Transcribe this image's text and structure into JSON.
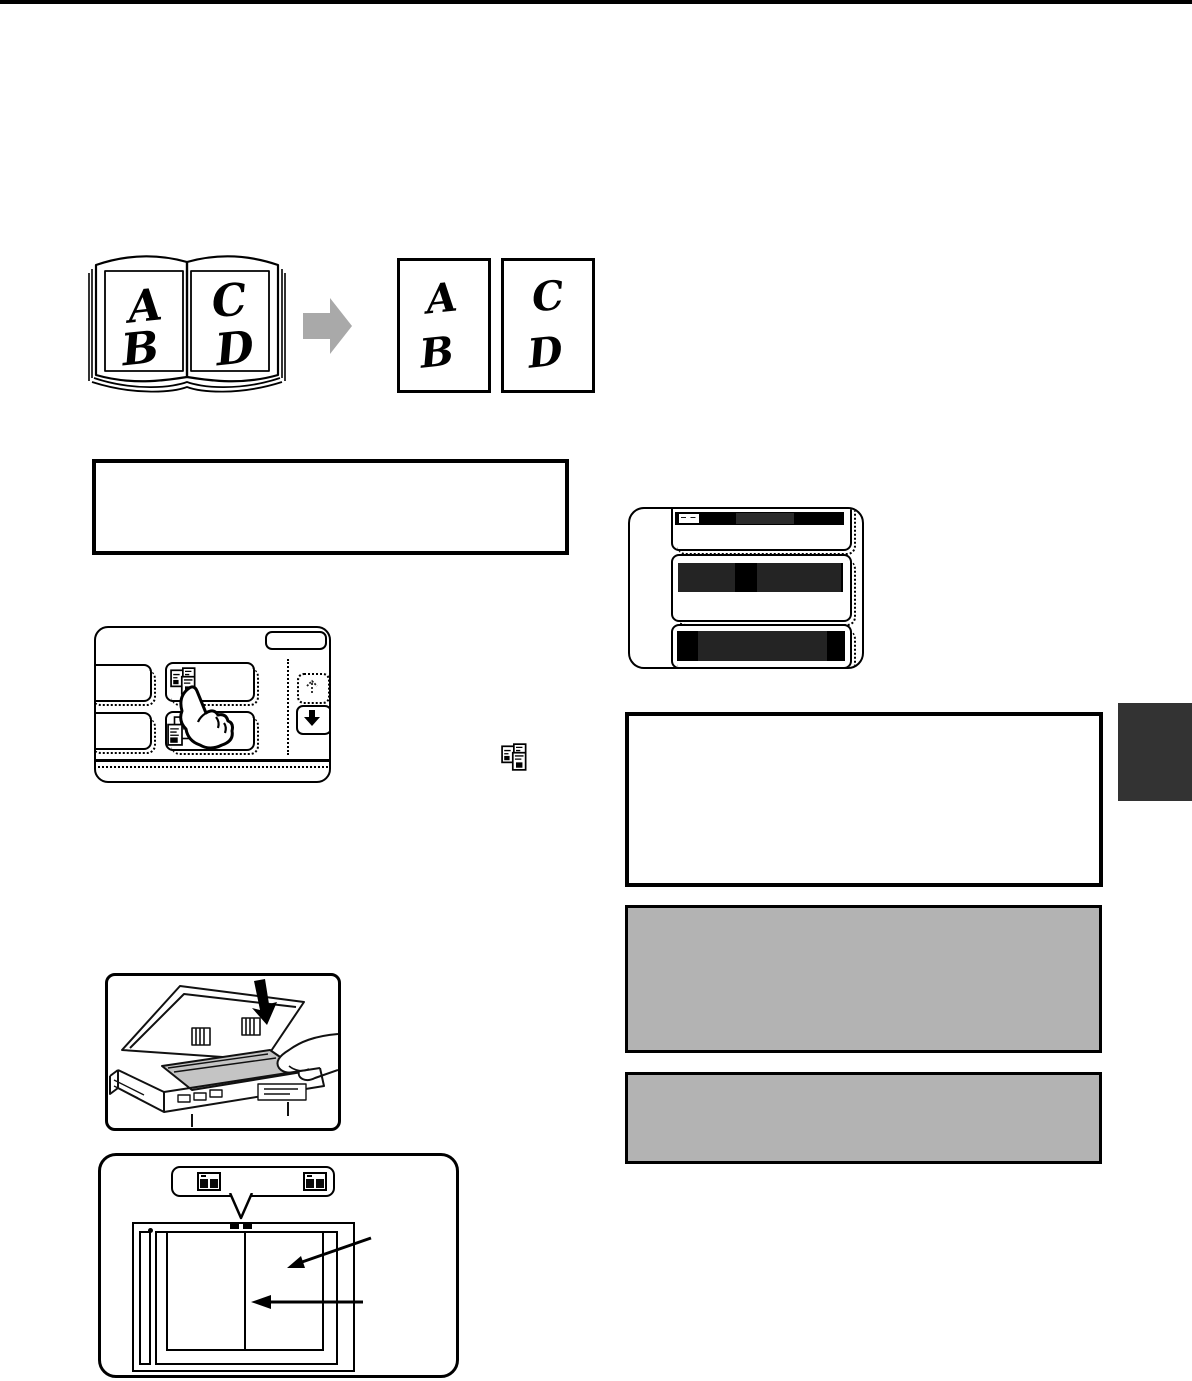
{
  "page": {
    "background": "#ffffff",
    "top_bar_color": "#000000",
    "section_tab_color": "#333333"
  },
  "colors": {
    "gray_box_fill": "#b3b3b3",
    "arrow_gray": "#a9a9a9",
    "glass_gray": "#c4c4c4",
    "screen_redaction_dark": "#242424",
    "screen_redaction_black": "#000000"
  },
  "figure_book_to_sheets": {
    "book_left_page": [
      "A",
      "B"
    ],
    "book_right_page": [
      "C",
      "D"
    ],
    "sheet_1": [
      "A",
      "B"
    ],
    "sheet_2": [
      "C",
      "D"
    ]
  },
  "panel_screen": {
    "header_dashes": "‒ ‒"
  },
  "icons": {
    "dual_page_copy_icon": "open book splitting into two separate pages",
    "stacked_pages_icon": "stacked sheets with text lines",
    "scroll_up_icon": "dashed up arrow",
    "scroll_down_icon": "solid black down arrow",
    "open_book_mark_icon": "open book original-size mark",
    "pointing_hand_icon": "hand with extended index finger",
    "transform_arrow_icon": "gray right block arrow",
    "place_original_arrow_icon": "black down arrow",
    "page_arrow_icon": "black diagonal arrow",
    "centerline_arrow_icon": "black horizontal left arrow"
  }
}
